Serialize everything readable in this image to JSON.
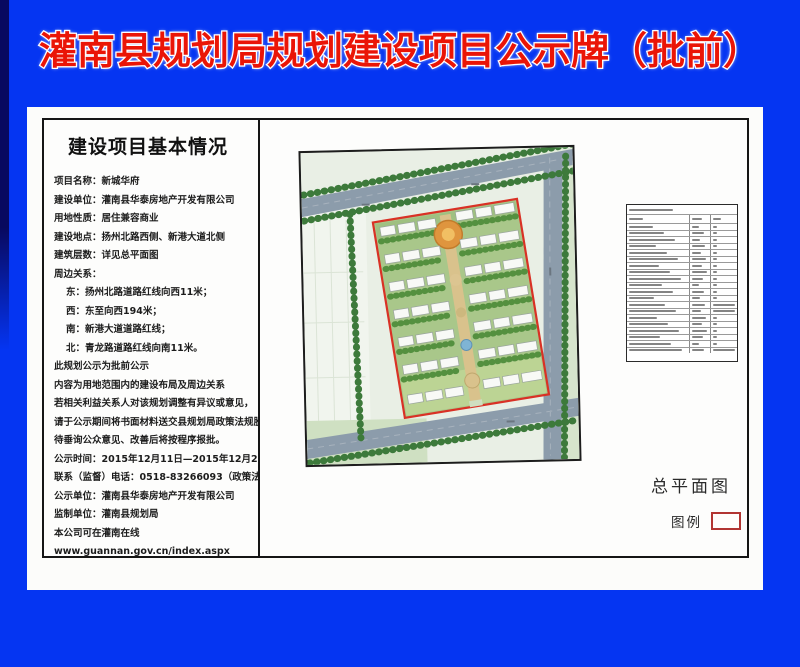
{
  "title": "灌南县规划局规划建设项目公示牌（批前）",
  "panel": {
    "heading": "建设项目基本情况",
    "lines": [
      {
        "text": "项目名称：新城华府",
        "indent": false
      },
      {
        "text": "建设单位：灌南县华泰房地产开发有限公司",
        "indent": false
      },
      {
        "text": "用地性质：居住兼容商业",
        "indent": false
      },
      {
        "text": "建设地点：扬州北路西侧、新港大道北侧",
        "indent": false
      },
      {
        "text": "建筑层数：详见总平面图",
        "indent": false
      },
      {
        "text": "周边关系：",
        "indent": false
      },
      {
        "text": "东：扬州北路道路红线向西11米；",
        "indent": true
      },
      {
        "text": "西：东至向西194米；",
        "indent": true
      },
      {
        "text": "南：新港大道道路红线；",
        "indent": true
      },
      {
        "text": "北：青龙路道路红线向南11米。",
        "indent": true
      },
      {
        "text": "此规划公示为批前公示",
        "indent": false
      },
      {
        "text": "内容为用地范围内的建设布局及周边关系",
        "indent": false
      },
      {
        "text": "若相关利益关系人对该规划调整有异议或意见，",
        "indent": false
      },
      {
        "text": "请于公示期间将书面材料送交县规划局政策法规股",
        "indent": false
      },
      {
        "text": "待垂询公众意见、改善后将按程序报批。",
        "indent": false
      },
      {
        "text": "公示时间：2015年12月11日—2015年12月20日",
        "indent": false
      },
      {
        "text": "联系（监督）电话：0518-83266093（政策法规股）",
        "indent": false
      },
      {
        "text": "公示单位：灌南县华泰房地产开发有限公司",
        "indent": false
      },
      {
        "text": "监制单位：灌南县规划局",
        "indent": false
      },
      {
        "text": "本公司可在灌南在线",
        "indent": false
      },
      {
        "text": "www.guannan.gov.cn/index.aspx",
        "indent": false
      }
    ]
  },
  "plan": {
    "caption": "总平面图",
    "legend_label": "图例"
  },
  "colors": {
    "background_blue": "#0535f2",
    "title_red": "#ea1507",
    "parcel_outline_red": "#d93125",
    "legend_outline_red": "#b23431",
    "road_gray": "#8c9cab"
  }
}
